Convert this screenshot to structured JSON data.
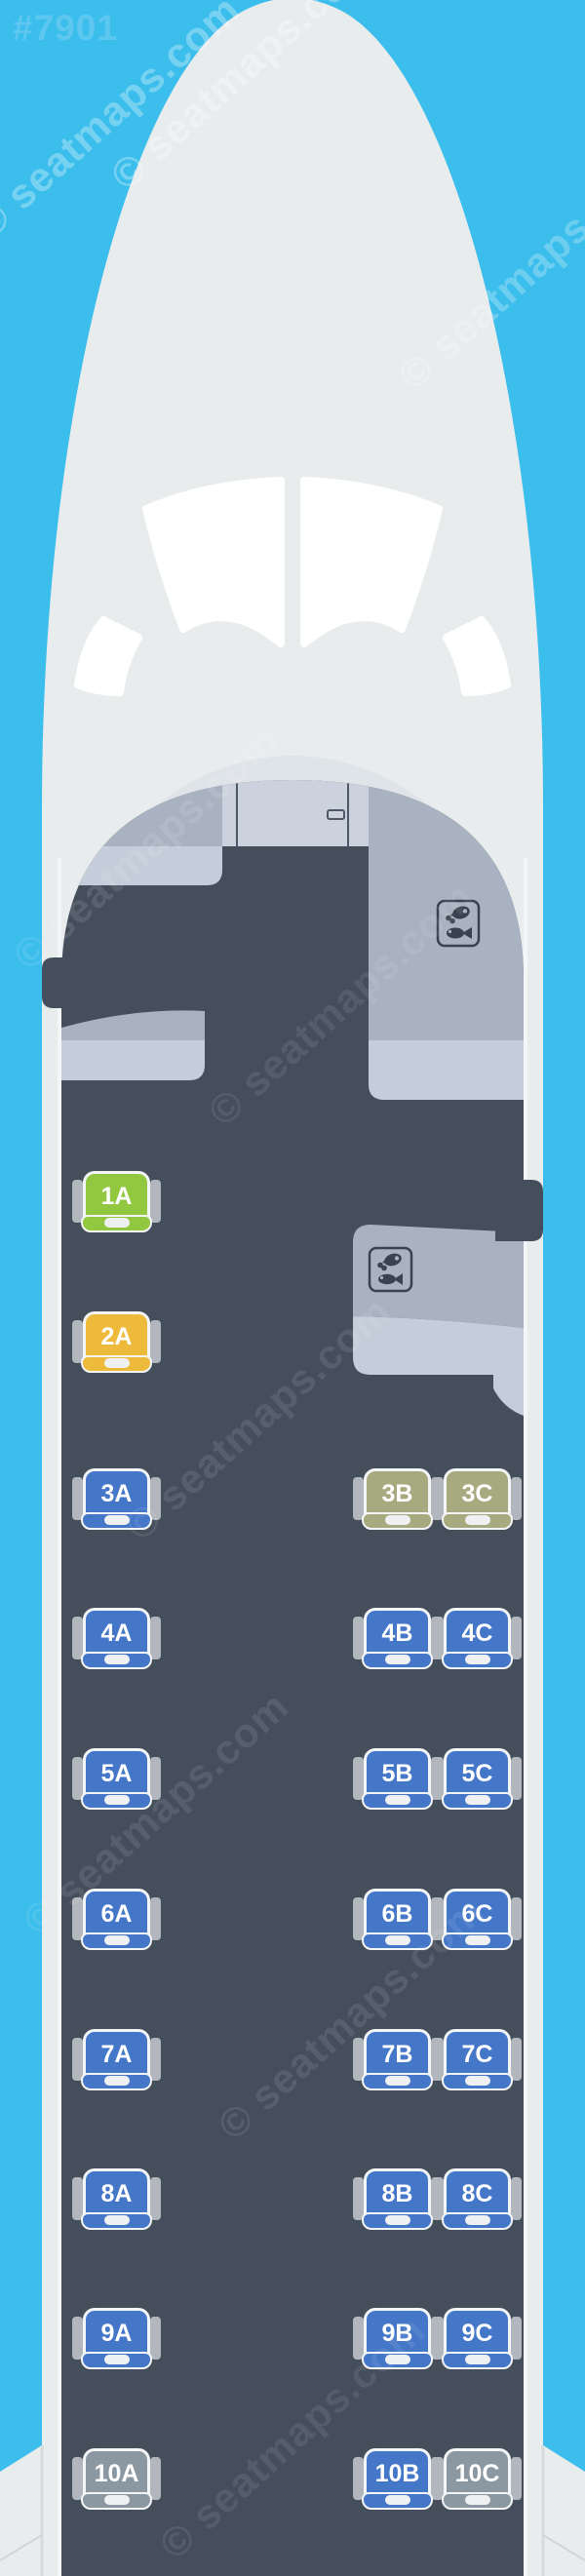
{
  "page_id": "#7901",
  "watermark": {
    "text": "© seatmaps.com"
  },
  "aircraft": {
    "type_note": "regional jet seat map, rows 1-10, columns A | B C",
    "seat_columns": [
      "A",
      "B",
      "C"
    ],
    "row_count": 10,
    "seat_colors": {
      "blue": "#4577c8",
      "green": "#92c83f",
      "yellow": "#eeba3c",
      "olive": "#a7aa7e",
      "gray": "#8c98a1"
    },
    "cabin_colors": {
      "background_blue": "#3cbeec",
      "fuselage": "#e8eced",
      "cabin_floor": "#454f5c",
      "galley_slate": "#a9b2c1",
      "galley_light": "#c4cdd9",
      "door_panel": "#cbd2dd",
      "icon_ink": "#39424e"
    },
    "galley_meal_icon_count": 2,
    "seats": [
      {
        "id": "1A",
        "row": 1,
        "col": "A",
        "type": "green"
      },
      {
        "id": "2A",
        "row": 2,
        "col": "A",
        "type": "yellow"
      },
      {
        "id": "3A",
        "row": 3,
        "col": "A",
        "type": "blue"
      },
      {
        "id": "3B",
        "row": 3,
        "col": "B",
        "type": "olive"
      },
      {
        "id": "3C",
        "row": 3,
        "col": "C",
        "type": "olive"
      },
      {
        "id": "4A",
        "row": 4,
        "col": "A",
        "type": "blue"
      },
      {
        "id": "4B",
        "row": 4,
        "col": "B",
        "type": "blue"
      },
      {
        "id": "4C",
        "row": 4,
        "col": "C",
        "type": "blue"
      },
      {
        "id": "5A",
        "row": 5,
        "col": "A",
        "type": "blue"
      },
      {
        "id": "5B",
        "row": 5,
        "col": "B",
        "type": "blue"
      },
      {
        "id": "5C",
        "row": 5,
        "col": "C",
        "type": "blue"
      },
      {
        "id": "6A",
        "row": 6,
        "col": "A",
        "type": "blue"
      },
      {
        "id": "6B",
        "row": 6,
        "col": "B",
        "type": "blue"
      },
      {
        "id": "6C",
        "row": 6,
        "col": "C",
        "type": "blue"
      },
      {
        "id": "7A",
        "row": 7,
        "col": "A",
        "type": "blue"
      },
      {
        "id": "7B",
        "row": 7,
        "col": "B",
        "type": "blue"
      },
      {
        "id": "7C",
        "row": 7,
        "col": "C",
        "type": "blue"
      },
      {
        "id": "8A",
        "row": 8,
        "col": "A",
        "type": "blue"
      },
      {
        "id": "8B",
        "row": 8,
        "col": "B",
        "type": "blue"
      },
      {
        "id": "8C",
        "row": 8,
        "col": "C",
        "type": "blue"
      },
      {
        "id": "9A",
        "row": 9,
        "col": "A",
        "type": "blue"
      },
      {
        "id": "9B",
        "row": 9,
        "col": "B",
        "type": "blue"
      },
      {
        "id": "9C",
        "row": 9,
        "col": "C",
        "type": "blue"
      },
      {
        "id": "10A",
        "row": 10,
        "col": "A",
        "type": "gray"
      },
      {
        "id": "10B",
        "row": 10,
        "col": "B",
        "type": "blue"
      },
      {
        "id": "10C",
        "row": 10,
        "col": "C",
        "type": "gray"
      }
    ]
  }
}
